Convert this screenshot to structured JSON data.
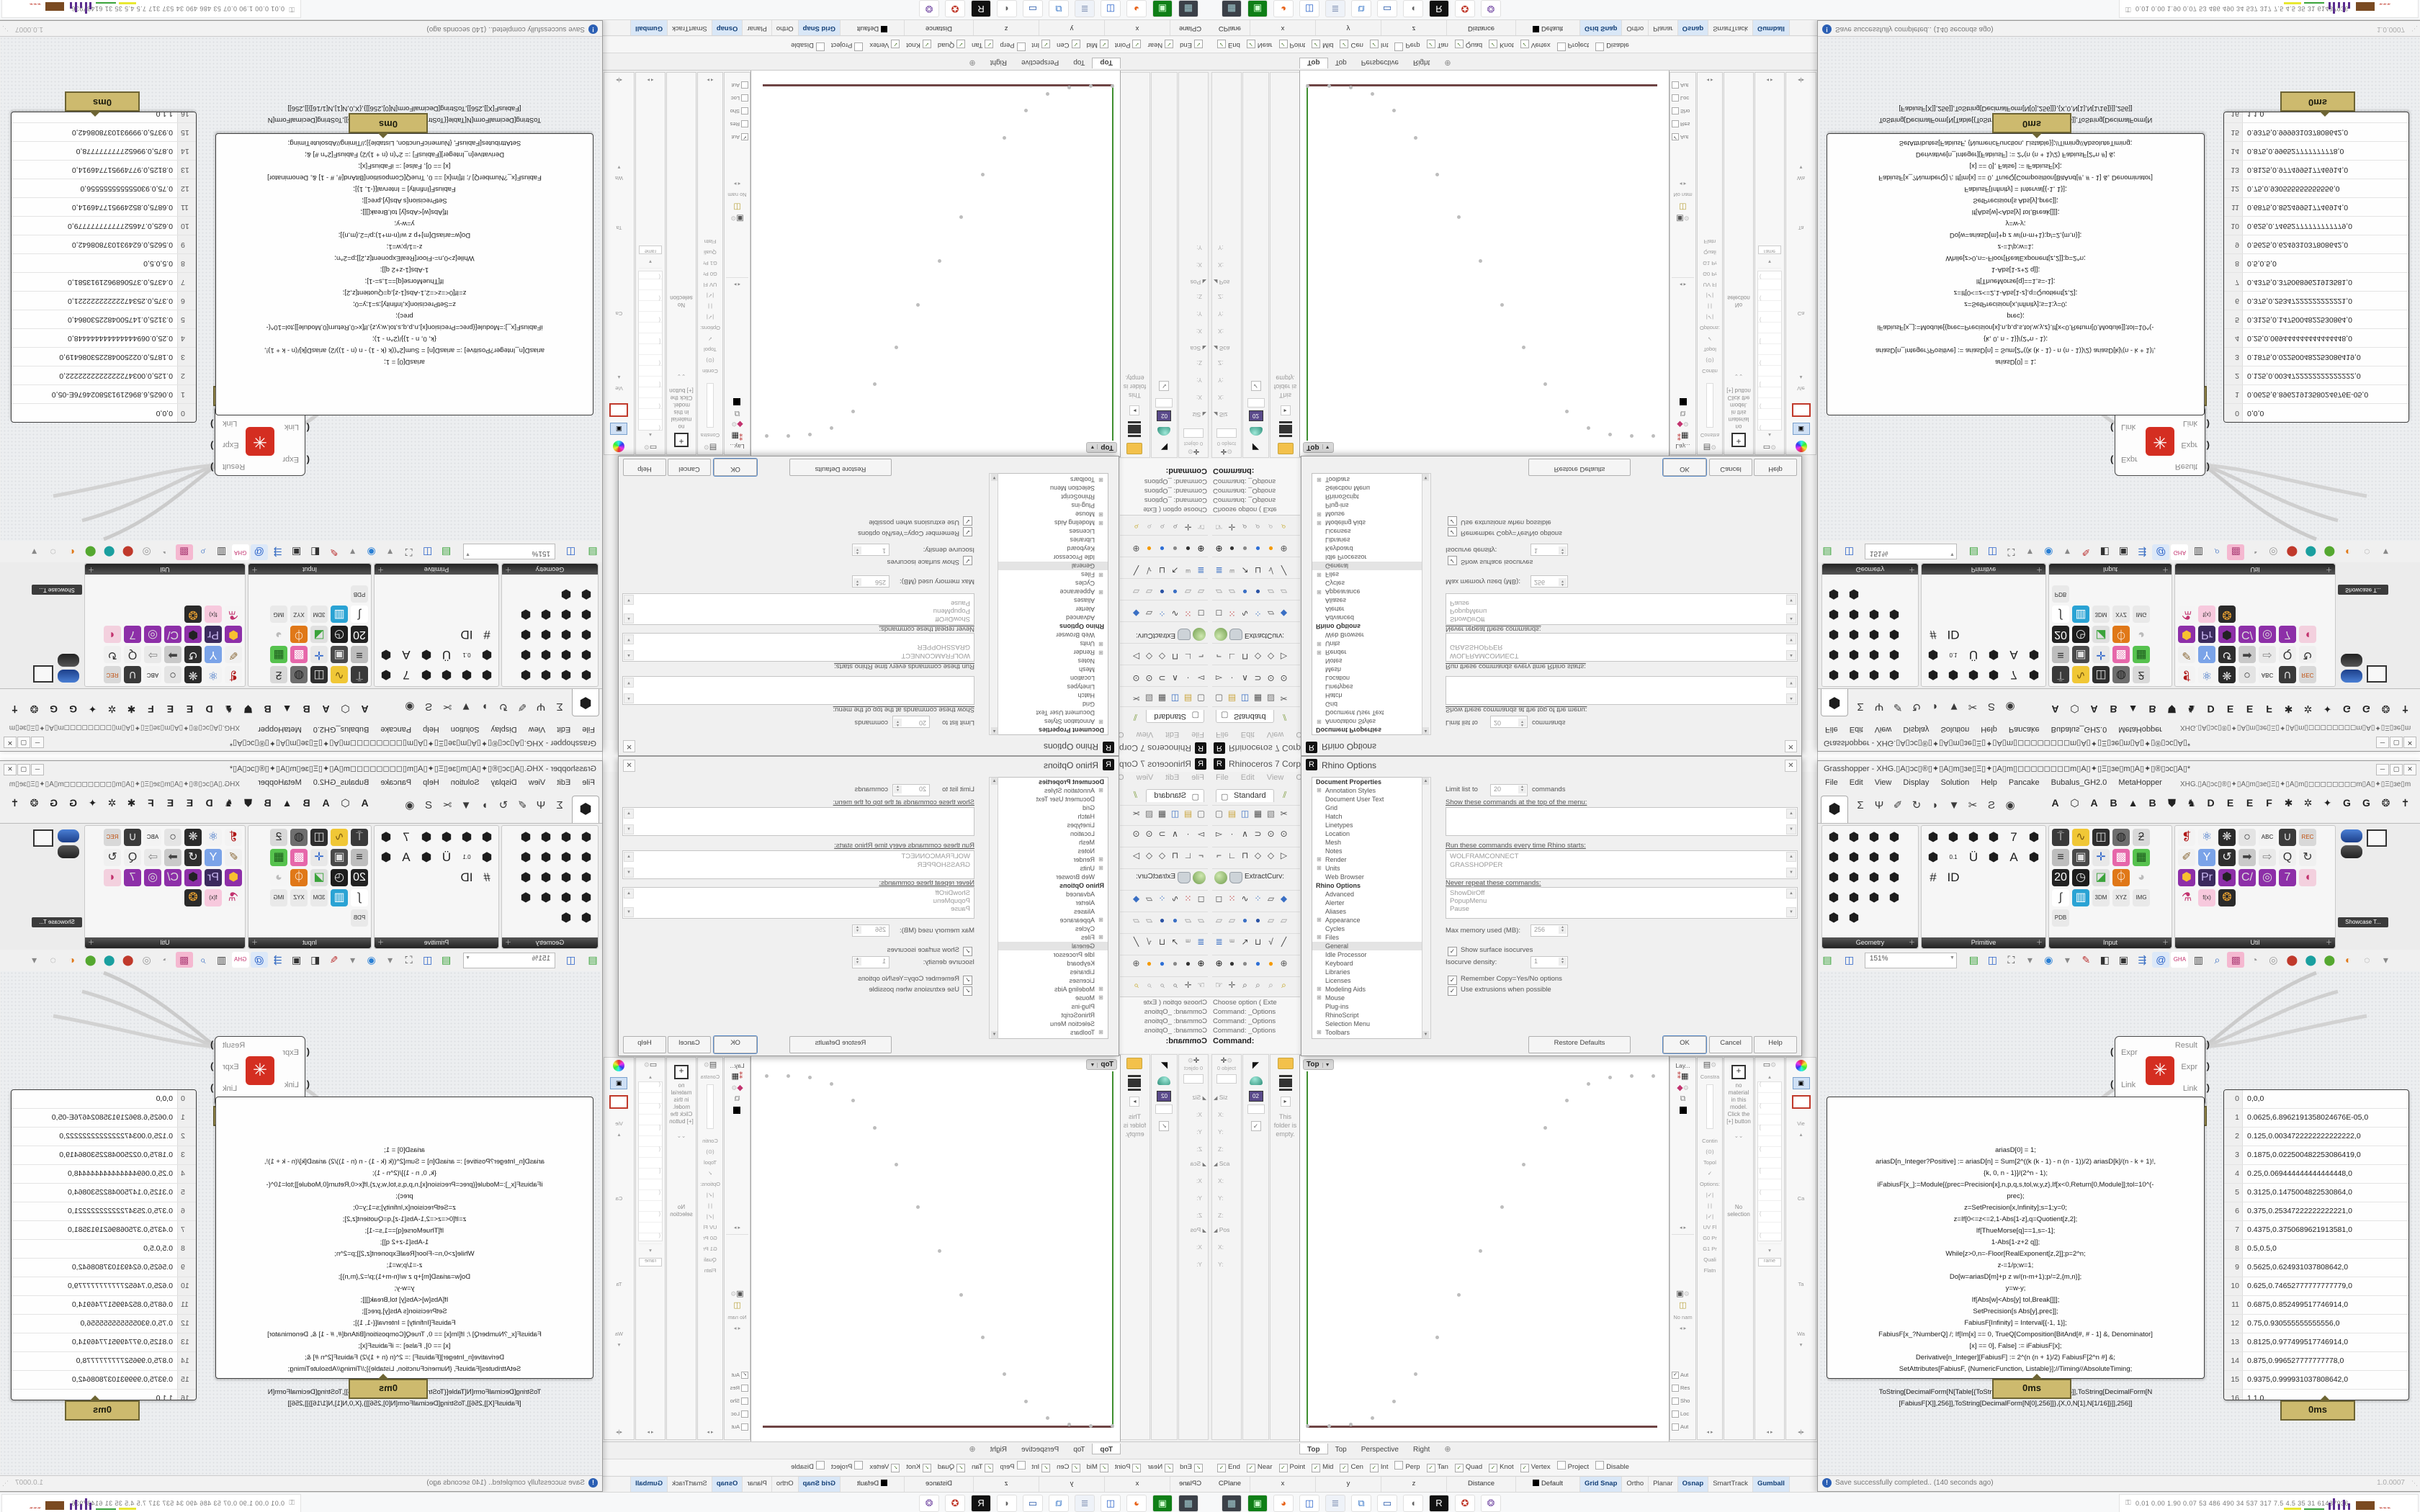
{
  "rhino": {
    "title": "Rhinoceros 7 Corporate -",
    "menu": [
      "File",
      "Edit",
      "View",
      "Curve"
    ],
    "tab": "Standard",
    "tb1": [
      {
        "g": "▢",
        "f": "#666"
      },
      {
        "g": "▤",
        "f": "#caa53d"
      },
      {
        "g": "◫",
        "f": "#3a6fc4"
      },
      {
        "g": "▦",
        "f": "#555"
      },
      {
        "g": "▧",
        "f": "#777"
      },
      {
        "g": "✂",
        "f": "#555"
      }
    ],
    "tb2": [
      {
        "g": "▻",
        "f": "#444"
      },
      {
        "g": "∙",
        "f": "#444"
      },
      {
        "g": "∧",
        "f": "#444"
      },
      {
        "g": "⊃",
        "f": "#444"
      },
      {
        "g": "⊙",
        "f": "#444"
      },
      {
        "g": "⊙",
        "f": "#444"
      }
    ],
    "tb3": [
      {
        "g": "⌐",
        "f": "#444"
      },
      {
        "g": "∟",
        "f": "#444"
      },
      {
        "g": "⊓",
        "f": "#444"
      },
      {
        "g": "◇",
        "f": "#444"
      },
      {
        "g": "◇",
        "f": "#444"
      },
      {
        "g": "▷",
        "f": "#444"
      }
    ],
    "tb5": [
      {
        "g": "◻",
        "f": "#555"
      },
      {
        "g": "⁙",
        "f": "#b33"
      },
      {
        "g": "∿",
        "f": "#444"
      },
      {
        "g": "⁘",
        "f": "#3a6fc4"
      },
      {
        "g": "▱",
        "f": "#555"
      },
      {
        "g": "◆",
        "f": "#3a6fc4"
      }
    ],
    "tb6": [
      {
        "g": "▱",
        "f": "#999"
      },
      {
        "g": "▱",
        "f": "#999"
      },
      {
        "g": "●",
        "f": "#3a6fc4"
      },
      {
        "g": "●",
        "f": "#2a52a4"
      },
      {
        "g": "▱",
        "f": "#999"
      },
      {
        "g": "▱",
        "f": "#999"
      }
    ],
    "tb7": [
      {
        "g": "≣",
        "f": "#3a6fc4"
      },
      {
        "g": "ᵚ",
        "f": "#777"
      },
      {
        "g": "↗",
        "f": "#444"
      },
      {
        "g": "⊔",
        "f": "#444"
      },
      {
        "g": "√",
        "f": "#444"
      },
      {
        "g": "╱",
        "f": "#444"
      }
    ],
    "tb8": [
      {
        "g": "⊕",
        "f": "#111"
      },
      {
        "g": "●",
        "f": "#333"
      },
      {
        "g": "●",
        "f": "#888"
      },
      {
        "g": "●",
        "f": "#2e6fd6"
      },
      {
        "g": "●",
        "f": "#f59a00"
      },
      {
        "g": "⊕",
        "f": "#555"
      }
    ],
    "tb9": [
      {
        "g": "☞",
        "f": "#666"
      },
      {
        "g": "✛",
        "f": "#666"
      },
      {
        "g": "⌕",
        "f": "#555"
      },
      {
        "g": "⌕",
        "f": "#777"
      },
      {
        "g": "⌕",
        "f": "#999"
      },
      {
        "g": "⌕",
        "f": "#b90"
      }
    ],
    "extract": "ExtractCurv:",
    "cmd_lines": [
      "Choose option ( Exte",
      "Command: _Options",
      "Command: _Options",
      "Command: _Options"
    ],
    "cmd_prompt": "Command:",
    "boxedit": {
      "header": "0 object",
      "sections": [
        {
          "t": "Siz"
        },
        {
          "t": "Sca"
        },
        {
          "t": "Pos"
        }
      ],
      "axes": [
        "X:",
        "Y:",
        "Z:"
      ]
    },
    "libraries": {
      "empty": "This folder is empty."
    },
    "viewport": {
      "title": "Top",
      "tabs": [
        "Top",
        "Top",
        "Perspective",
        "Right"
      ]
    },
    "osnap": [
      {
        "label": "End",
        "checked": true
      },
      {
        "label": "Near",
        "checked": true
      },
      {
        "label": "Point",
        "checked": true
      },
      {
        "label": "Mid",
        "checked": true
      },
      {
        "label": "Cen",
        "checked": true
      },
      {
        "label": "Int",
        "checked": true
      },
      {
        "label": "Perp",
        "checked": false
      },
      {
        "label": "Tan",
        "checked": true
      },
      {
        "label": "Quad",
        "checked": true
      },
      {
        "label": "Knot",
        "checked": true
      },
      {
        "label": "Vertex",
        "checked": true
      },
      {
        "label": "Project",
        "checked": false
      },
      {
        "label": "Disable",
        "checked": false
      }
    ],
    "status_cells": [
      "CPlane",
      "x",
      "y",
      "z",
      "Distance"
    ],
    "default_layer": "Default",
    "status_toggles": [
      {
        "label": "Grid Snap",
        "on": true
      },
      {
        "label": "Ortho",
        "on": false
      },
      {
        "label": "Planar",
        "on": false
      },
      {
        "label": "Osnap",
        "on": true
      },
      {
        "label": "SmartTrack",
        "on": false
      },
      {
        "label": "Gumball",
        "on": true
      },
      {
        "label": "Record History",
        "on": false
      },
      {
        "label": "Filter",
        "on": false
      },
      {
        "label": "A",
        "on": false
      }
    ],
    "strips": {
      "layers_title": "Lay...",
      "named_views": "No nam",
      "view_checks": [
        {
          "label": "Aut",
          "checked": true
        },
        {
          "label": "Res",
          "checked": false
        },
        {
          "label": "Sho",
          "checked": false
        },
        {
          "label": "Loc",
          "checked": false
        },
        {
          "label": "Aut",
          "checked": false
        }
      ],
      "constraints": [
        "Constra",
        "Contin",
        "Topol",
        "Options:",
        "UV Fl",
        "G0 Pr",
        "G1 Pr",
        "Quali",
        "Flatn"
      ],
      "material_note": "no material in this model. Click the [+] button",
      "no_selection": "No selection",
      "props": [
        "Vie",
        "Ca",
        "Ta",
        "Wa"
      ],
      "display_field": "rame"
    }
  },
  "dialog": {
    "title": "Rhino Options",
    "tree_head1": "Document Properties",
    "tree1": [
      {
        "label": "Annotation Styles",
        "plus": true
      },
      {
        "label": "Document User Text"
      },
      {
        "label": "Grid"
      },
      {
        "label": "Hatch"
      },
      {
        "label": "Linetypes"
      },
      {
        "label": "Location"
      },
      {
        "label": "Mesh"
      },
      {
        "label": "Notes"
      },
      {
        "label": "Render",
        "plus": true
      },
      {
        "label": "Units",
        "plus": true
      },
      {
        "label": "Web Browser"
      }
    ],
    "tree_head2": "Rhino Options",
    "tree2": [
      {
        "label": "Advanced"
      },
      {
        "label": "Alerter"
      },
      {
        "label": "Aliases"
      },
      {
        "label": "Appearance",
        "plus": true
      },
      {
        "label": "Cycles"
      },
      {
        "label": "Files",
        "plus": true
      },
      {
        "label": "General",
        "selected": true
      },
      {
        "label": "Idle Processor"
      },
      {
        "label": "Keyboard"
      },
      {
        "label": "Libraries"
      },
      {
        "label": "Licenses"
      },
      {
        "label": "Modeling Aids",
        "plus": true
      },
      {
        "label": "Mouse",
        "plus": true
      },
      {
        "label": "Plug-ins"
      },
      {
        "label": "RhinoScript"
      },
      {
        "label": "Selection Menu"
      },
      {
        "label": "Toolbars",
        "plus": true
      }
    ],
    "limit_label": "Limit list to",
    "limit_value": "20",
    "limit_suffix": "commands",
    "show_label": "Show these commands at the top of the menu:",
    "run_label": "Run these commands every time Rhino starts:",
    "run_items": [
      "WOLFRAMCONNECT",
      "GRASSHOPPER"
    ],
    "never_label": "Never repeat these commands:",
    "never_items": [
      "ShowDirOff",
      "PopupMenu",
      "Pause"
    ],
    "memory_label": "Max memory used (MB):",
    "memory_value": "256",
    "iso_check": "Show surface isocurves",
    "density_label": "Isocurve density:",
    "density_value": "1",
    "remember_check": "Remember Copy=Yes/No options",
    "extrusion_check": "Use extrusions when possible",
    "btn_restore": "Restore Defaults",
    "btn_ok": "OK",
    "btn_cancel": "Cancel",
    "btn_help": "Help"
  },
  "gh": {
    "title": "Grasshopper - XHG.▯A▯ɔc▯®▯✦▯A▯m▯ɜe▯Ξ▯✦▯A▯m▯◻◻◻◻◻◻◻◻m▯A▯✦▯Ξ▯ɜe▯m▯A▯✦▯®▯ɔc▯A▯*",
    "menu": [
      "File",
      "Edit",
      "View",
      "Display",
      "Solution",
      "Help",
      "Pancake",
      "Bubalus_GH2.0",
      "MetaHopper"
    ],
    "menu_right": "XHG.▯A▯ɔc▯®▯✦▯A▯m▯ɜe▯Ξ▯✦▯A▯m▯◻◻◻◻◻◻◻◻m▯A▯✦▯Ξ▯ɜe▯m▯A▯✦▯®▯ɔc▯A▯",
    "active_tab_glyph": "⬢",
    "tab_glyphs": [
      "Σ",
      "Ψ",
      "✐",
      "↻",
      "◗",
      "▼",
      "✂",
      "Ƨ",
      "◉"
    ],
    "plugin_tabs": [
      "A",
      "⬡",
      "A",
      "B",
      "▲",
      "B",
      "⛊",
      "♞",
      "D",
      "E",
      "E",
      "F",
      "✱",
      "✲",
      "✦",
      "G",
      "G",
      "❂",
      "✝"
    ],
    "group_names": [
      "Geometry",
      "Primitive",
      "Input",
      "Util"
    ],
    "geometry_tiles": [
      "⬢",
      "⬢",
      "⬢",
      "⬢",
      "⬢",
      "⬢",
      "⬢",
      "⬢",
      "⬢",
      "⬢",
      "⬢",
      "⬢",
      "⬢",
      "⬢",
      "⬢",
      "⬢",
      "⬢",
      "⬢"
    ],
    "primitive_tiles": [
      "⬢",
      "⬢",
      "⬢",
      "⬢",
      "7",
      "⬢",
      "⬢",
      "0.1",
      "Ü",
      "⬢",
      "A",
      "⬢",
      "#",
      "ID"
    ],
    "input_tiles": [
      {
        "g": "⍑",
        "c": "#3a3a3a",
        "f": "#eee"
      },
      {
        "g": "∿",
        "c": "#f0c736",
        "f": "#7a5a10"
      },
      {
        "g": "◫",
        "c": "#2e2e2e",
        "f": "#ddd"
      },
      {
        "g": "◍",
        "c": "#6e6e6e",
        "f": "#222"
      },
      {
        "g": "ƻ",
        "c": "#d8d8d8",
        "f": "#333"
      },
      {
        "g": "≡",
        "c": "#bdbdbd",
        "f": "#333"
      },
      {
        "g": "▣",
        "c": "#4a4a4a",
        "f": "#ddd"
      },
      {
        "g": "✛",
        "c": "#e8e8e8",
        "f": "#2a62c9"
      },
      {
        "g": "▩",
        "c": "#e667aa",
        "f": "#fff"
      },
      {
        "g": "▦",
        "c": "#56c24e",
        "f": "#1d5c1d"
      },
      {
        "g": "20",
        "c": "#222",
        "f": "#fff"
      },
      {
        "g": "◷",
        "c": "#1d1d1d",
        "f": "#eee"
      },
      {
        "g": "◪",
        "c": "#e0e0e0",
        "f": "#3aa33a"
      },
      {
        "g": "⏀",
        "c": "#e07818",
        "f": "#fff"
      },
      {
        "g": "◕",
        "c": "#f5f5f5",
        "f": "#bbb"
      },
      {
        "g": "∫",
        "c": "#fff",
        "f": "#333"
      },
      {
        "g": "▥",
        "c": "#2aa3d4",
        "f": "#fff"
      },
      {
        "g": "3DM",
        "c": "#e9e9e9",
        "f": "#333"
      },
      {
        "g": "XYZ",
        "c": "#e9e9e9",
        "f": "#333"
      },
      {
        "g": "IMG",
        "c": "#e9e9e9",
        "f": "#333"
      },
      {
        "g": "PDB",
        "c": "#e9e9e9",
        "f": "#333"
      }
    ],
    "util_tiles": [
      {
        "g": "❡",
        "c": "#f3f3f3",
        "f": "#b01818"
      },
      {
        "g": "⚛",
        "c": "#f3f3f3",
        "f": "#3a6fc4"
      },
      {
        "g": "❋",
        "c": "#2a2a2a",
        "f": "#ddd"
      },
      {
        "g": "○",
        "c": "#e4e4e4",
        "f": "#333"
      },
      {
        "g": "ABC",
        "c": "#f3f3f3",
        "f": "#222"
      },
      {
        "g": "∪",
        "c": "#3a3a3a",
        "f": "#ddd"
      },
      {
        "g": "REC",
        "c": "#d8d8d8",
        "f": "#c05010"
      },
      {
        "g": "✐",
        "c": "#f0f0f0",
        "f": "#8a6a3a"
      },
      {
        "g": "Y",
        "c": "#7aa3e8",
        "f": "#fff"
      },
      {
        "g": "↺",
        "c": "#2e2e2e",
        "f": "#eee"
      },
      {
        "g": "➡",
        "c": "#c9c9c9",
        "f": "#444"
      },
      {
        "g": "⇨",
        "c": "#e9e9e9",
        "f": "#888"
      },
      {
        "g": "Q",
        "c": "#f0f0f0",
        "f": "#333"
      },
      {
        "g": "↻",
        "c": "#f0f0f0",
        "f": "#333"
      },
      {
        "g": "⬢",
        "c": "#8d2fa8",
        "f": "#f8c030"
      },
      {
        "g": "Pr",
        "c": "#3b2a5e",
        "f": "#c9b8f0"
      },
      {
        "g": "⬢",
        "c": "#8d2fa8",
        "f": "#222"
      },
      {
        "g": "C/",
        "c": "#8d2fa8",
        "f": "#ddd"
      },
      {
        "g": "◎",
        "c": "#8d2fa8",
        "f": "#ddd"
      },
      {
        "g": "7",
        "c": "#8d2fa8",
        "f": "#ddd"
      },
      {
        "g": "◖",
        "c": "#f3d0de",
        "f": "#c2326e"
      },
      {
        "g": "⚗",
        "c": "#f5f5f5",
        "f": "#c2326e"
      },
      {
        "g": "f(x)",
        "c": "#f7c9dd",
        "f": "#333"
      },
      {
        "g": "❂",
        "c": "#2a2a2a",
        "f": "#e8a030"
      }
    ],
    "showcase": "Showcase T...",
    "zoom": "151%",
    "canvasbar": [
      {
        "g": "▤",
        "f": "#2f9e2f"
      },
      {
        "g": "◫",
        "f": "#2a62c9"
      },
      {
        "g": "⛶",
        "f": "#444"
      },
      {
        "g": "▾",
        "f": "#888"
      },
      {
        "g": "◉",
        "f": "#2a7fd4"
      },
      {
        "g": "▾",
        "f": "#888"
      },
      {
        "g": "✎",
        "f": "#b33"
      },
      {
        "g": "◧",
        "f": "#333"
      },
      {
        "g": "▣",
        "f": "#333"
      },
      {
        "g": "⇶",
        "f": "#3a6fc4"
      },
      {
        "g": "@",
        "c": "#dce8f8",
        "f": "#2a62c9"
      },
      {
        "g": "GHA",
        "c": "#fff",
        "f": "#c2326e"
      },
      {
        "g": "▥",
        "f": "#444"
      },
      {
        "g": "⌕",
        "f": "#3a6fc4"
      },
      {
        "g": "▩",
        "c": "#f5b8d0",
        "f": "#b2487e"
      },
      {
        "g": "◔",
        "f": "#999"
      },
      {
        "g": "◎",
        "f": "#999"
      },
      {
        "g": "⬤",
        "f": "#c0392b"
      },
      {
        "g": "⬤",
        "f": "#1a9f9f"
      },
      {
        "g": "⬤",
        "f": "#55a830"
      },
      {
        "g": "◐",
        "f": "#e07818"
      },
      {
        "g": "◌",
        "f": "#888"
      },
      {
        "g": "▾",
        "f": "#888"
      }
    ],
    "component": {
      "inputs": [
        "Expr",
        "Link"
      ],
      "outputs": [
        "Result",
        "Expr",
        "Link"
      ],
      "time": "5ms"
    },
    "code_time": "0ms",
    "data_time": "0ms",
    "code_lines": [
      "ariasD[0] = 1;",
      "ariasD[n_Integer?Positive] := ariasD[n] = Sum[2^((k (k - 1) - n (n - 1))/2) ariasD[k]/(n - k + 1)!,",
      "{k, 0, n - 1}]/(2^n - 1);",
      "iFabiusF[x_]:=Module[{prec=Precision[x],n,p,q,s,tol,w,y,z},If[x<0,Return[0,Module]];tol=10^(-",
      "prec);",
      "z=SetPrecision[x,Infinity];s=1;y=0;",
      "z=If[0<=z<=2,1-Abs[1-z],q=Quotient[z,2];",
      "If[ThueMorse[q]==1,s=-1];",
      "1-Abs[1-z+2 q]];",
      "While[z>0,n=-Floor[RealExponent[z,2]];p=2^n;",
      "z-=1/p;w=1;",
      "Do[w=ariasD[m]+p z w/(n-m+1);p/=2,{m,n}];",
      "y=w-y;",
      "If[Abs[w]<Abs[y] tol,Break[]]];",
      "SetPrecision[s Abs[y],prec]];",
      "FabiusF[Infinity] = Interval[{-1, 1}];",
      "FabiusF[x_?NumberQ] /; If[Im[x] == 0, TrueQ[Composition[BitAnd[#, # - 1] &, Denominator]",
      "[x] == 0], False] := iFabiusF[x];",
      "Derivative[n_Integer][FabiusF] := 2^(n (n + 1)/2) FabiusF[2^n #] &;",
      "SetAttributes[FabiusF, {NumericFunction, Listable}];//Timing//AbsoluteTiming;",
      "",
      "ToString[DecimalForm[N[Table[{ToString[DecimalForm[N[X],256]],ToString[DecimalForm[N",
      "[FabiusF[X]],256]],ToString[DecimalForm[N[0],256]]},{X,0,N[1],N[1/16]}]],256]]"
    ],
    "data_rows": [
      "0,0,0",
      "0.0625,6.8962191358024676E-05,0",
      "0.125,0.0034722222222222222,0",
      "0.1875,0.022500482253086419,0",
      "0.25,0.069444444444444448,0",
      "0.3125,0.1475004822530864,0",
      "0.375,0.25347222222222221,0",
      "0.4375,0.3750689621913581,0",
      "0.5,0.5,0",
      "0.5625,0.624931037808642,0",
      "0.625,0.74652777777777779,0",
      "0.6875,0.852499517746914,0",
      "0.75,0.930555555555556,0",
      "0.8125,0.977499517746914,0",
      "0.875,0.996527777777778,0",
      "0.9375,0.999931037808642,0",
      "1,1,0"
    ],
    "status": "Save successfully completed.. (140 seconds ago)",
    "version": "1.0.0007"
  },
  "taskbar": {
    "icons": [
      {
        "g": "▦",
        "c": "#3b4048",
        "f": "#9fc8cc"
      },
      {
        "g": "▣",
        "c": "#0f7f17",
        "f": "#cfc"
      },
      {
        "g": "◕",
        "c": "#fff",
        "f": "#e8641b"
      },
      {
        "g": "◫",
        "c": "#fff",
        "f": "#2a62c9"
      },
      {
        "g": "≣",
        "c": "#eef2f8",
        "f": "#8898b8"
      },
      {
        "g": "⧉",
        "c": "#fff",
        "f": "#3a78c9"
      },
      {
        "g": "▭",
        "c": "#fff",
        "f": "#2456a8"
      },
      {
        "g": "◖",
        "c": "#fff",
        "f": "#666"
      },
      {
        "g": "R",
        "c": "#111",
        "f": "#fff"
      },
      {
        "g": "✪",
        "c": "#fff",
        "f": "#c0392b"
      },
      {
        "g": "❂",
        "c": "#fff",
        "f": "#7a52a8"
      }
    ],
    "perf": "0.01 0.00 1.90 0.07   53   486  490   34   537  317   7.5   4.5   35    31  61437936"
  },
  "chart_data": {
    "type": "scatter",
    "title": "Fabius function samples plotted as points in Rhino Top viewport",
    "x": [
      0,
      0.0625,
      0.125,
      0.1875,
      0.25,
      0.3125,
      0.375,
      0.4375,
      0.5,
      0.5625,
      0.625,
      0.6875,
      0.75,
      0.8125,
      0.875,
      0.9375,
      1
    ],
    "y": [
      0,
      6.89621913580247e-05,
      0.003472222222222222,
      0.02250048225308642,
      0.06944444444444445,
      0.1475004822530864,
      0.2534722222222222,
      0.3750689621913581,
      0.5,
      0.624931037808642,
      0.7465277777777778,
      0.852499517746914,
      0.930555555555556,
      0.977499517746914,
      0.996527777777778,
      0.999931037808642,
      1
    ],
    "xlabel": "",
    "ylabel": "",
    "xlim": [
      0,
      1
    ],
    "ylim": [
      0,
      1
    ],
    "grid": false,
    "legend": false
  }
}
